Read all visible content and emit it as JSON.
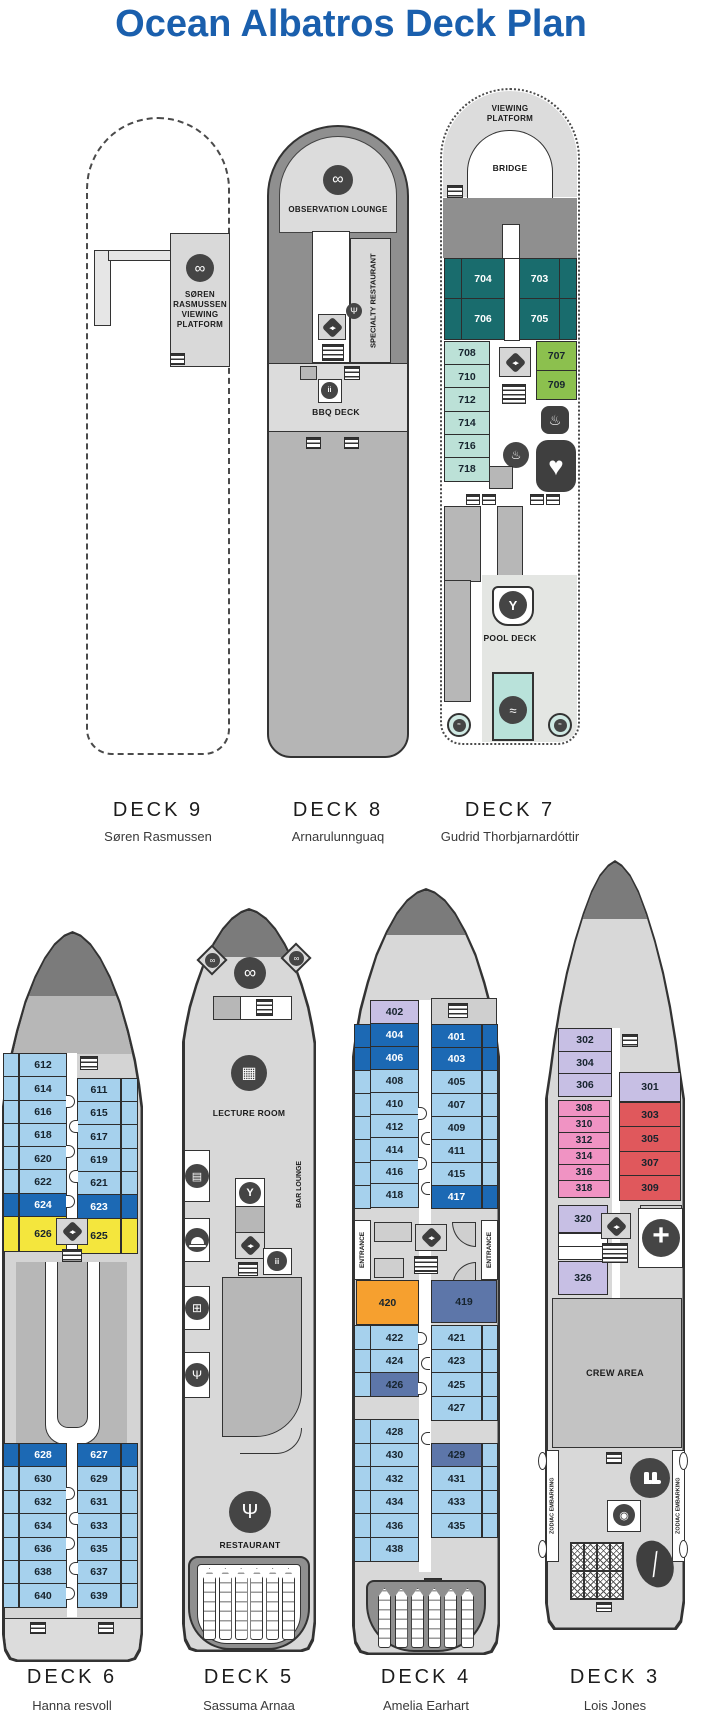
{
  "title": "Ocean Albatros Deck Plan",
  "palette": {
    "title_blue": "#1a5fad",
    "cabin_light_blue": "#a6d1ed",
    "cabin_dark_blue": "#1c69b4",
    "cabin_teal": "#196c6d",
    "cabin_mint": "#bce1d7",
    "cabin_green": "#8cc04e",
    "cabin_yellow": "#f4e63d",
    "cabin_orange": "#f6a02f",
    "cabin_slate": "#5d76a9",
    "cabin_lavender": "#c7bfe4",
    "cabin_pink": "#f093c3",
    "cabin_red": "#e0585c",
    "hull_light": "#d8d8d8",
    "hull_mid": "#b7b7b7",
    "hull_dark": "#8f8f8f",
    "pool_teal": "#b9e2da"
  },
  "icons": {
    "binoculars": "∞",
    "elevator": "◂▸",
    "restaurant": "Ψ",
    "cutlery": "Ψ",
    "cocktail": "Y",
    "pool_ladder": "≈",
    "waves": "≈",
    "spa": "♨",
    "steam": "♨",
    "heart": "♥",
    "medical": "+",
    "wc": "ii",
    "lecture": "▦",
    "library": "▤",
    "gift": "⊞",
    "whirlpool": "◉",
    "paddle": "╱"
  },
  "decks": {
    "deck9": {
      "label": "DECK 9",
      "person": "Søren Rasmussen",
      "platform": "SØREN RASMUSSEN VIEWING PLATFORM"
    },
    "deck8": {
      "label": "DECK 8",
      "person": "Arnarulunnguaq",
      "observation": "OBSERVATION LOUNGE",
      "specialty": "SPECIALTY RESTAURANT",
      "bbq": "BBQ DECK"
    },
    "deck7": {
      "label": "DECK 7",
      "person": "Gudrid Thorbjarnardóttir",
      "viewing": "VIEWING PLATFORM",
      "bridge": "BRIDGE",
      "pool": "POOL DECK",
      "suite_strip_left": [
        {
          "t": "teal"
        },
        {
          "t": "teal"
        }
      ],
      "suites_left": [
        {
          "n": "704",
          "t": "teal"
        },
        {
          "n": "706",
          "t": "teal"
        }
      ],
      "suites_right": [
        {
          "n": "703",
          "t": "teal"
        },
        {
          "n": "705",
          "t": "teal"
        }
      ],
      "suite_strip_right": [
        {
          "t": "teal"
        },
        {
          "t": "teal"
        }
      ],
      "cabins_left": [
        {
          "n": "708",
          "t": "mint"
        },
        {
          "n": "710",
          "t": "mint"
        },
        {
          "n": "712",
          "t": "mint"
        },
        {
          "n": "714",
          "t": "mint"
        },
        {
          "n": "716",
          "t": "mint"
        },
        {
          "n": "718",
          "t": "mint"
        }
      ],
      "cabins_right": [
        {
          "n": "707",
          "t": "green"
        },
        {
          "n": "709",
          "t": "green"
        }
      ]
    },
    "deck6": {
      "label": "DECK 6",
      "person": "Hanna resvoll",
      "upper_strip_left": [
        {
          "t": "lb"
        },
        {
          "t": "lb"
        },
        {
          "t": "lb"
        },
        {
          "t": "lb"
        },
        {
          "t": "lb"
        },
        {
          "t": "lb"
        },
        {
          "t": "blue"
        },
        {
          "t": "yellow",
          "h": 1.45
        }
      ],
      "upper_left": [
        {
          "n": "612",
          "t": "lb"
        },
        {
          "n": "614",
          "t": "lb"
        },
        {
          "n": "616",
          "t": "lb"
        },
        {
          "n": "618",
          "t": "lb"
        },
        {
          "n": "620",
          "t": "lb"
        },
        {
          "n": "622",
          "t": "lb"
        },
        {
          "n": "624",
          "t": "blue"
        },
        {
          "n": "626",
          "t": "yellow",
          "h": 1.45
        }
      ],
      "upper_right": [
        {
          "n": "611",
          "t": "lb"
        },
        {
          "n": "615",
          "t": "lb"
        },
        {
          "n": "617",
          "t": "lb"
        },
        {
          "n": "619",
          "t": "lb"
        },
        {
          "n": "621",
          "t": "lb"
        },
        {
          "n": "623",
          "t": "blue"
        },
        {
          "n": "625",
          "t": "yellow",
          "h": 1.45
        }
      ],
      "upper_strip_right": [
        {
          "t": "lb"
        },
        {
          "t": "lb"
        },
        {
          "t": "lb"
        },
        {
          "t": "lb"
        },
        {
          "t": "lb"
        },
        {
          "t": "blue"
        },
        {
          "t": "yellow",
          "h": 1.45
        }
      ],
      "lower_strip_left": [
        {
          "t": "blue"
        },
        {
          "t": "lb"
        },
        {
          "t": "lb"
        },
        {
          "t": "lb"
        },
        {
          "t": "lb"
        },
        {
          "t": "lb"
        },
        {
          "t": "lb"
        }
      ],
      "lower_left": [
        {
          "n": "628",
          "t": "blue"
        },
        {
          "n": "630",
          "t": "lb"
        },
        {
          "n": "632",
          "t": "lb"
        },
        {
          "n": "634",
          "t": "lb"
        },
        {
          "n": "636",
          "t": "lb"
        },
        {
          "n": "638",
          "t": "lb"
        },
        {
          "n": "640",
          "t": "lb"
        }
      ],
      "lower_right": [
        {
          "n": "627",
          "t": "blue"
        },
        {
          "n": "629",
          "t": "lb"
        },
        {
          "n": "631",
          "t": "lb"
        },
        {
          "n": "633",
          "t": "lb"
        },
        {
          "n": "635",
          "t": "lb"
        },
        {
          "n": "637",
          "t": "lb"
        },
        {
          "n": "639",
          "t": "lb"
        }
      ],
      "lower_strip_right": [
        {
          "t": "blue"
        },
        {
          "t": "lb"
        },
        {
          "t": "lb"
        },
        {
          "t": "lb"
        },
        {
          "t": "lb"
        },
        {
          "t": "lb"
        },
        {
          "t": "lb"
        }
      ]
    },
    "deck5": {
      "label": "DECK 5",
      "person": "Sassuma Arnaa",
      "lecture": "LECTURE ROOM",
      "bar": "BAR LOUNGE",
      "restaurant": "RESTAURANT",
      "zodiacs": [
        {},
        {},
        {},
        {},
        {},
        {}
      ]
    },
    "deck4": {
      "label": "DECK 4",
      "person": "Amelia Earhart",
      "entrance": "ENTRANCE",
      "upper_left": [
        {
          "n": "402",
          "t": "lav"
        },
        {
          "n": "404",
          "t": "blue"
        },
        {
          "n": "406",
          "t": "blue"
        },
        {
          "n": "408",
          "t": "lb"
        },
        {
          "n": "410",
          "t": "lb"
        },
        {
          "n": "412",
          "t": "lb"
        },
        {
          "n": "414",
          "t": "lb"
        },
        {
          "n": "416",
          "t": "lb"
        },
        {
          "n": "418",
          "t": "lb"
        }
      ],
      "upper_right": [
        {
          "n": "401",
          "t": "blue"
        },
        {
          "n": "403",
          "t": "blue"
        },
        {
          "n": "405",
          "t": "lb"
        },
        {
          "n": "407",
          "t": "lb"
        },
        {
          "n": "409",
          "t": "lb"
        },
        {
          "n": "411",
          "t": "lb"
        },
        {
          "n": "415",
          "t": "lb"
        },
        {
          "n": "417",
          "t": "blue"
        }
      ],
      "upper_strip_left": [
        {
          "t": "blue"
        },
        {
          "t": "blue"
        },
        {
          "t": "lb"
        },
        {
          "t": "lb"
        },
        {
          "t": "lb"
        },
        {
          "t": "lb"
        },
        {
          "t": "lb"
        },
        {
          "t": "lb"
        }
      ],
      "upper_strip_right": [
        {
          "t": "blue"
        },
        {
          "t": "blue"
        },
        {
          "t": "lb"
        },
        {
          "t": "lb"
        },
        {
          "t": "lb"
        },
        {
          "t": "lb"
        },
        {
          "t": "lb"
        },
        {
          "t": "blue"
        }
      ],
      "cabin_420": {
        "n": "420",
        "t": "orange"
      },
      "cabin_419": {
        "n": "419",
        "t": "slate"
      },
      "lower_left": [
        {
          "n": "422",
          "t": "lb"
        },
        {
          "n": "424",
          "t": "lb"
        },
        {
          "n": "426",
          "t": "slate"
        },
        {
          "t": "gap"
        },
        {
          "n": "428",
          "t": "lb"
        },
        {
          "n": "430",
          "t": "lb"
        },
        {
          "n": "432",
          "t": "lb"
        },
        {
          "n": "434",
          "t": "lb"
        },
        {
          "n": "436",
          "t": "lb"
        },
        {
          "n": "438",
          "t": "lb"
        }
      ],
      "lower_right": [
        {
          "n": "421",
          "t": "lb"
        },
        {
          "n": "423",
          "t": "lb"
        },
        {
          "n": "425",
          "t": "lb"
        },
        {
          "n": "427",
          "t": "lb"
        },
        {
          "t": "gap"
        },
        {
          "n": "429",
          "t": "slate"
        },
        {
          "n": "431",
          "t": "lb"
        },
        {
          "n": "433",
          "t": "lb"
        },
        {
          "n": "435",
          "t": "lb"
        },
        {
          "t": "gap"
        }
      ],
      "lower_strip_left": [
        {
          "t": "lb"
        },
        {
          "t": "lb"
        },
        {
          "t": "lb"
        },
        {
          "t": "gap"
        },
        {
          "t": "lb"
        },
        {
          "t": "lb"
        },
        {
          "t": "lb"
        },
        {
          "t": "lb"
        },
        {
          "t": "lb"
        },
        {
          "t": "lb"
        }
      ],
      "lower_strip_right": [
        {
          "t": "lb"
        },
        {
          "t": "lb"
        },
        {
          "t": "lb"
        },
        {
          "t": "lb"
        },
        {
          "t": "gap"
        },
        {
          "t": "lb"
        },
        {
          "t": "lb"
        },
        {
          "t": "lb"
        },
        {
          "t": "lb"
        },
        {
          "t": "gap"
        }
      ],
      "zodiacs": [
        {},
        {},
        {},
        {},
        {},
        {}
      ]
    },
    "deck3": {
      "label": "DECK 3",
      "person": "Lois Jones",
      "crew": "CREW AREA",
      "zodiac_embarking": "ZODIAC EMBARKING",
      "lavender_left": [
        {
          "n": "302",
          "t": "lav"
        },
        {
          "n": "304",
          "t": "lav"
        },
        {
          "n": "306",
          "t": "lav"
        }
      ],
      "pink_left": [
        {
          "n": "308",
          "t": "pink"
        },
        {
          "n": "310",
          "t": "pink"
        },
        {
          "n": "312",
          "t": "pink"
        },
        {
          "n": "314",
          "t": "pink"
        },
        {
          "n": "316",
          "t": "pink"
        },
        {
          "n": "318",
          "t": "pink"
        }
      ],
      "white_rows": [
        {
          "t": "white"
        },
        {
          "t": "white"
        }
      ],
      "cabin_320": {
        "n": "320",
        "t": "lav"
      },
      "cabin_326": {
        "n": "326",
        "t": "lav"
      },
      "cabin_301": {
        "n": "301",
        "t": "lav"
      },
      "red_right": [
        {
          "n": "303",
          "t": "red"
        },
        {
          "n": "305",
          "t": "red"
        },
        {
          "n": "307",
          "t": "red"
        },
        {
          "n": "309",
          "t": "red"
        }
      ]
    }
  }
}
